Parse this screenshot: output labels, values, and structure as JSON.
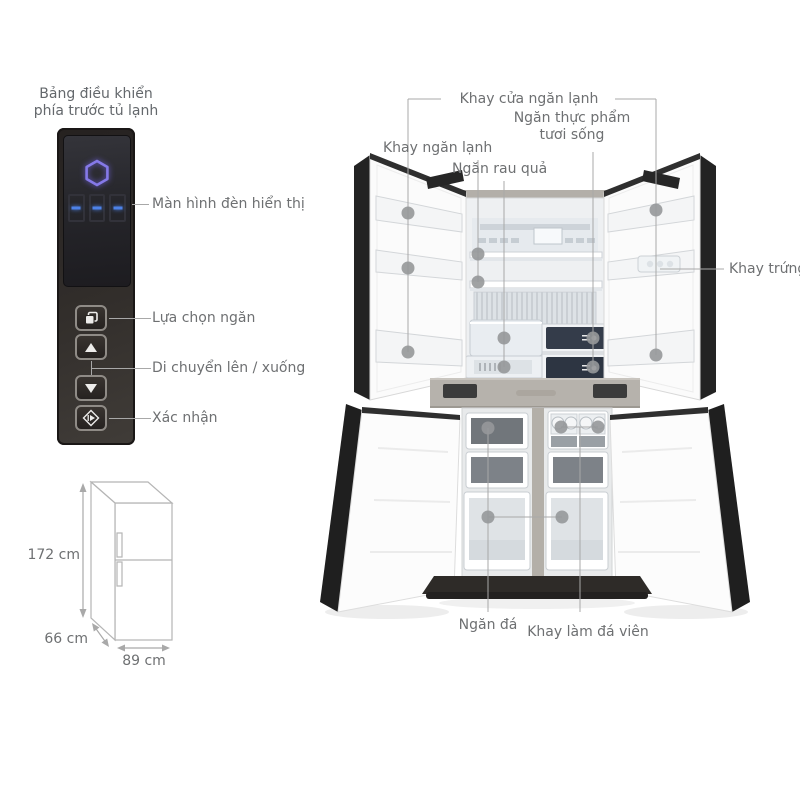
{
  "control_panel": {
    "title_line1": "Bảng điều khiển",
    "title_line2": "phía trước tủ lạnh",
    "display_label": "Màn hình đèn hiển thị",
    "select_label": "Lựa chọn ngăn",
    "updown_label": "Di chuyển lên / xuống",
    "confirm_label": "Xác nhận",
    "display_digit_count": 3,
    "icons": {
      "logo": "hexagon-logo-icon",
      "select": "layers-icon",
      "up": "triangle-up-icon",
      "down": "triangle-down-icon",
      "confirm": "diamond-start-icon"
    },
    "colors": {
      "panel": "#2b2724",
      "hexagon_glow": "#8579e8",
      "digit_dash": "#4d82e8"
    }
  },
  "dimensions": {
    "height": "172 cm",
    "depth": "66 cm",
    "width": "89 cm"
  },
  "callouts": {
    "door_tray": "Khay cửa ngăn lạnh",
    "fresh_food": "Ngăn thực phẩm tươi sống",
    "cold_tray": "Khay ngăn lạnh",
    "vegetable": "Ngăn rau quả",
    "egg_tray": "Khay trứng",
    "freezer": "Ngăn đá",
    "ice_cube_tray": "Khay làm đá viên"
  },
  "style": {
    "annotation_line": "#a8a8a8",
    "annotation_dot": "#96989a",
    "label_text": "#6e7072",
    "background": "#ffffff"
  }
}
